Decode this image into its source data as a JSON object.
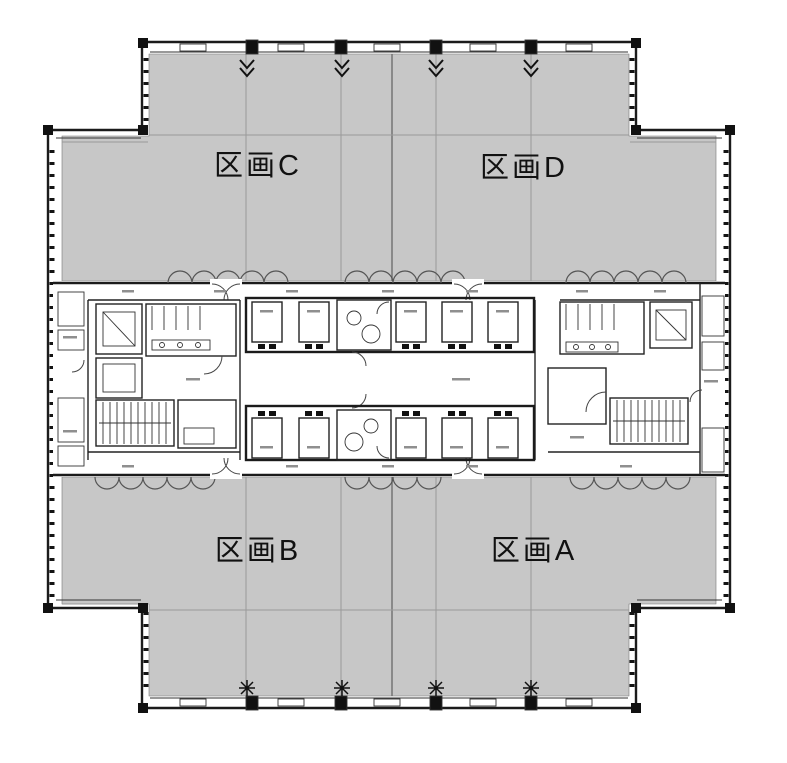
{
  "sections": [
    {
      "id": "C",
      "label": "区画C"
    },
    {
      "id": "D",
      "label": "区画D"
    },
    {
      "id": "B",
      "label": "区画B"
    },
    {
      "id": "A",
      "label": "区画A"
    }
  ],
  "colors": {
    "floor": "#c7c7c7",
    "wall": "#1b1b1b",
    "line": "#3a3a3a",
    "grid": "#9a9a9a",
    "bg": "#ffffff"
  },
  "icons": {
    "north_wall_symbol": "vent-arrow-down-icon",
    "south_wall_symbol": "column-star-marker-icon"
  }
}
